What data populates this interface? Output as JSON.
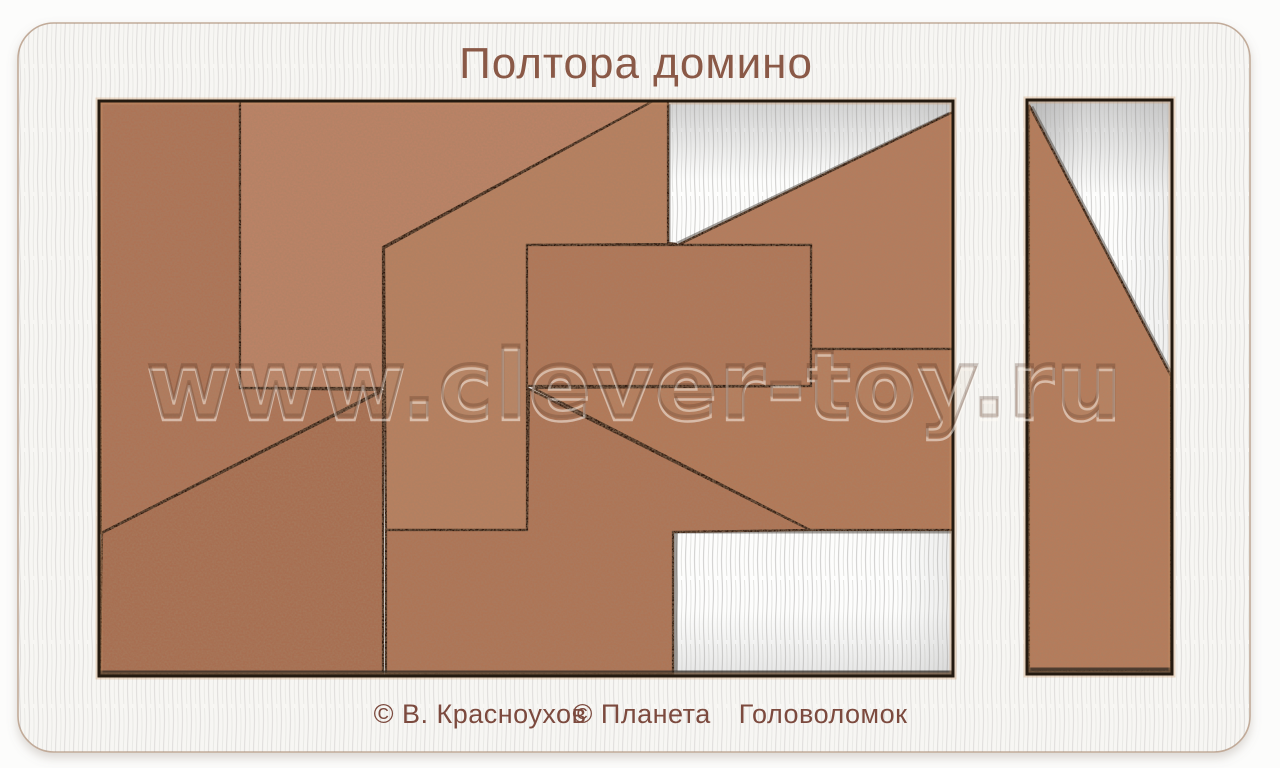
{
  "title": "Полтора домино",
  "watermark": "www.clever-toy.ru",
  "credits": {
    "author": "© В. Красноухов",
    "publisher": "© Планета  Головоломок"
  },
  "colors": {
    "background": "#fcfcfb",
    "board": "#f7f6f3",
    "board_edge": "#c2ab99",
    "recess_line": "#241a10",
    "burn_halo": "#d29868",
    "recess_floor": "#fdfdfc",
    "piece_edge": "#2b180d",
    "piece_base": "#b27a5b",
    "engraving_title": "#8a5947",
    "engraving_credits": "#7c4a3e"
  },
  "puzzle": {
    "trays": [
      {
        "id": "main",
        "x": 99,
        "y": 101,
        "w": 854,
        "h": 575,
        "shadow_lines": [
          [
            668,
            104,
            668,
            243
          ],
          [
            678,
            244,
            950,
            114
          ],
          [
            673,
            531,
            951,
            531
          ],
          [
            675,
            532,
            675,
            671
          ]
        ],
        "wall_lines": [
          [
            100,
            673,
            952,
            673
          ]
        ],
        "pieces": [
          {
            "id": "left-pentagon",
            "fill": "#ad7356",
            "points": "99,101 240,101 240,388 382,390 101,533"
          },
          {
            "id": "top-pentagon",
            "fill": "#bb8366",
            "points": "240,101 653,101 383,247 383,388 240,388"
          },
          {
            "id": "center-left-polygon",
            "fill": "#b78061",
            "points": "653,101 668,101 668,243 677,244 527,245 527,530 386,530 384,248"
          },
          {
            "id": "top-right-notched",
            "fill": "#b57b5d",
            "points": "678,245 953,112 953,349 811,349 811,245"
          },
          {
            "id": "center-domino",
            "fill": "#b07758",
            "points": "527,245 811,245 811,386 527,386"
          },
          {
            "id": "right-wedge",
            "fill": "#b37959",
            "points": "811,349 953,349 953,530 810,530 533,388 811,386"
          },
          {
            "id": "bottom-center-polygon",
            "fill": "#ae7456",
            "points": "529,389 810,530 673,532 673,674 386,674 386,530 527,530"
          },
          {
            "id": "bottom-left-wedge",
            "fill": "#a86e51",
            "points": "102,533 383,391 383,674 100,674"
          }
        ]
      },
      {
        "id": "right",
        "x": 1027,
        "y": 100,
        "w": 145,
        "h": 574,
        "shadow_lines": [
          [
            1031,
            107,
            1170,
            373
          ]
        ],
        "wall_lines": [
          [
            1028,
            670,
            1171,
            670
          ]
        ],
        "pieces": [
          {
            "id": "tall-diagonal",
            "fill": "#b67b5c",
            "points": "1029,105 1171,376 1171,671 1029,671"
          }
        ]
      }
    ]
  }
}
